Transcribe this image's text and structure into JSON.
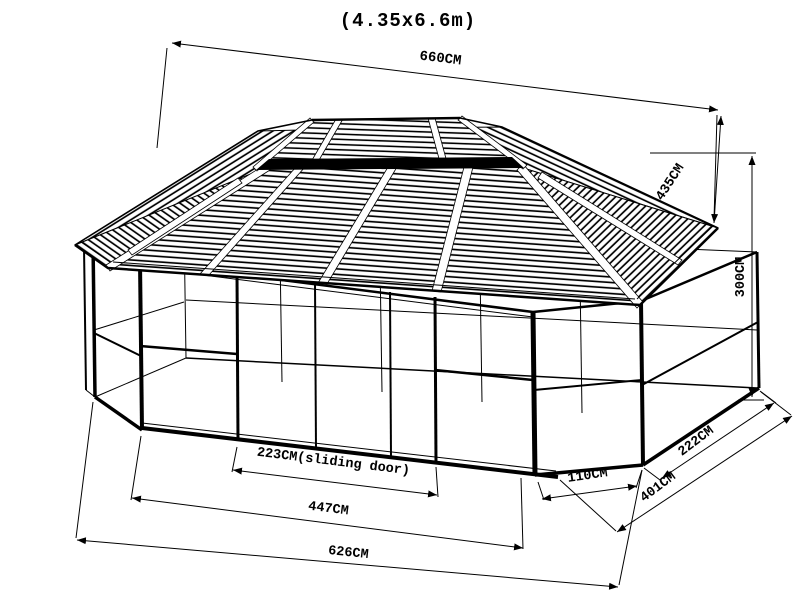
{
  "title": "(4.35x6.6m)",
  "drawing": {
    "subject": "gazebo technical line drawing, isometric view",
    "line_color": "#000000",
    "background_color": "#ffffff"
  },
  "dimensions": {
    "overall_roof_length": "660CM",
    "roof_end_width": "435CM",
    "height": "300CM",
    "sliding_door": "223CM(sliding door)",
    "front_section": "447CM",
    "base_length": "626CM",
    "corner_panel": "110CM",
    "side_panel": "222CM",
    "end_base_width": "401CM"
  }
}
